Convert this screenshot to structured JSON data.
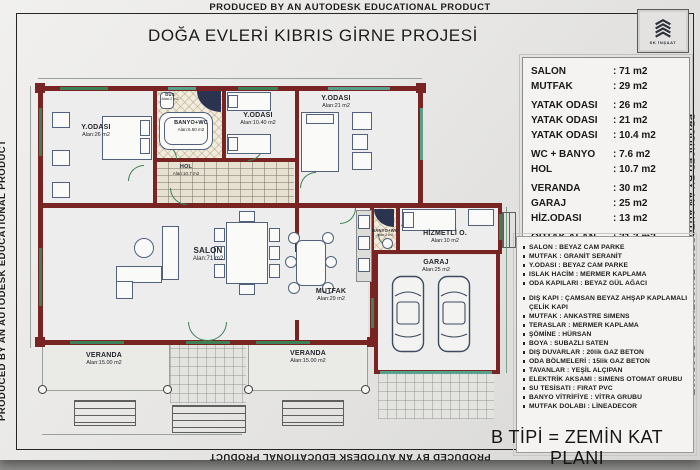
{
  "watermark": "PRODUCED BY AN AUTODESK EDUCATIONAL PRODUCT",
  "title": "DOĞA EVLERİ KIBRIS GİRNE PROJESİ",
  "logo": {
    "company": "SK İNŞAAT"
  },
  "footer": "B TİPİ = ZEMİN KAT PLANI",
  "area_table": {
    "rows": [
      {
        "label": "SALON",
        "value": ": 71 m2"
      },
      {
        "label": "MUTFAK",
        "value": ": 29 m2"
      },
      {
        "label": "YATAK ODASI",
        "value": ": 26 m2"
      },
      {
        "label": "YATAK ODASI",
        "value": ": 21 m2"
      },
      {
        "label": "YATAK ODASI",
        "value": ": 10.4 m2"
      },
      {
        "label": "WC + BANYO",
        "value": ": 7.6 m2"
      },
      {
        "label": "HOL",
        "value": ": 10.7 m2"
      },
      {
        "label": "VERANDA",
        "value": ": 30  m2"
      },
      {
        "label": "GARAJ",
        "value": ": 25  m2"
      },
      {
        "label": "HİZ.ODASI",
        "value": ": 13  m2"
      },
      {
        "label": "ORTAK ALAN",
        "value": ": 31.3 m2"
      },
      {
        "label": "TOPLAM İNŞ",
        "value": ": 275  m2"
      }
    ]
  },
  "specs": {
    "groups": [
      [
        "SALON : BEYAZ CAM PARKE",
        "MUTFAK : GRANİT SERANİT",
        "Y.ODASI : BEYAZ CAM PARKE",
        "ISLAK HACİM : MERMER KAPLAMA",
        "ODA KAPILARI : BEYAZ GÜL AĞACI"
      ],
      [
        "DIŞ KAPI : ÇAMSAN BEYAZ AHŞAP KAPLAMALI ÇELİK KAPI",
        "MUTFAK : ANKASTRE SIMENS",
        "TERASLAR : MERMER KAPLAMA",
        "ŞÖMİNE : HÜRSAN",
        "BOYA : SUBAZLI SATEN",
        "DIŞ DUVARLAR : 20lik GAZ BETON",
        "ODA BÖLMELERİ : 15lik GAZ BETON",
        "TAVANLAR : YEŞİL ALÇIPAN",
        "ELEKTRİK AKSAMI : SIMENS OTOMAT GRUBU",
        "SU TESİSATI : FIRAT PVC",
        "BANYO VİTRİFİYE : VİTRA GRUBU",
        "MUTFAK DOLABI : LİNEADECOR"
      ]
    ]
  },
  "rooms": {
    "bedroom1": {
      "name": "Y.ODASI",
      "area": "Alan:26 m2"
    },
    "banyo": {
      "name": "BANYO+WC",
      "area": "Alan:6.50 m2"
    },
    "dus": {
      "name": "DUŞ",
      "area": "Alan:2 m2"
    },
    "bedroom2": {
      "name": "Y.ODASI",
      "area": "Alan:10.40 m2"
    },
    "hol": {
      "name": "HOL",
      "area": "Alan:10.7 m2"
    },
    "bedroom3": {
      "name": "Y.ODASI",
      "area": "Alan:21 m2"
    },
    "salon": {
      "name": "SALON",
      "area": "Alan:71 m2"
    },
    "mutfak": {
      "name": "MUTFAK",
      "area": "Alan:29 m2"
    },
    "banyo2": {
      "name": "BANYO+WC",
      "area": "Alan:2 m2"
    },
    "hizmetli": {
      "name": "HİZMETLİ O.",
      "area": "Alan:10 m2"
    },
    "garaj": {
      "name": "GARAJ",
      "area": "Alan:25 m2"
    },
    "veranda_left": {
      "name": "VERANDA",
      "area": "Alan:15.00 m2"
    },
    "veranda_right": {
      "name": "VERANDA",
      "area": "Alan:15.00 m2"
    }
  },
  "colors": {
    "wall": "#772422",
    "window_green": "#3e8058",
    "logo_navy": "#2a2f3a",
    "furniture": "#53617c",
    "paper": "#ecebe9"
  }
}
